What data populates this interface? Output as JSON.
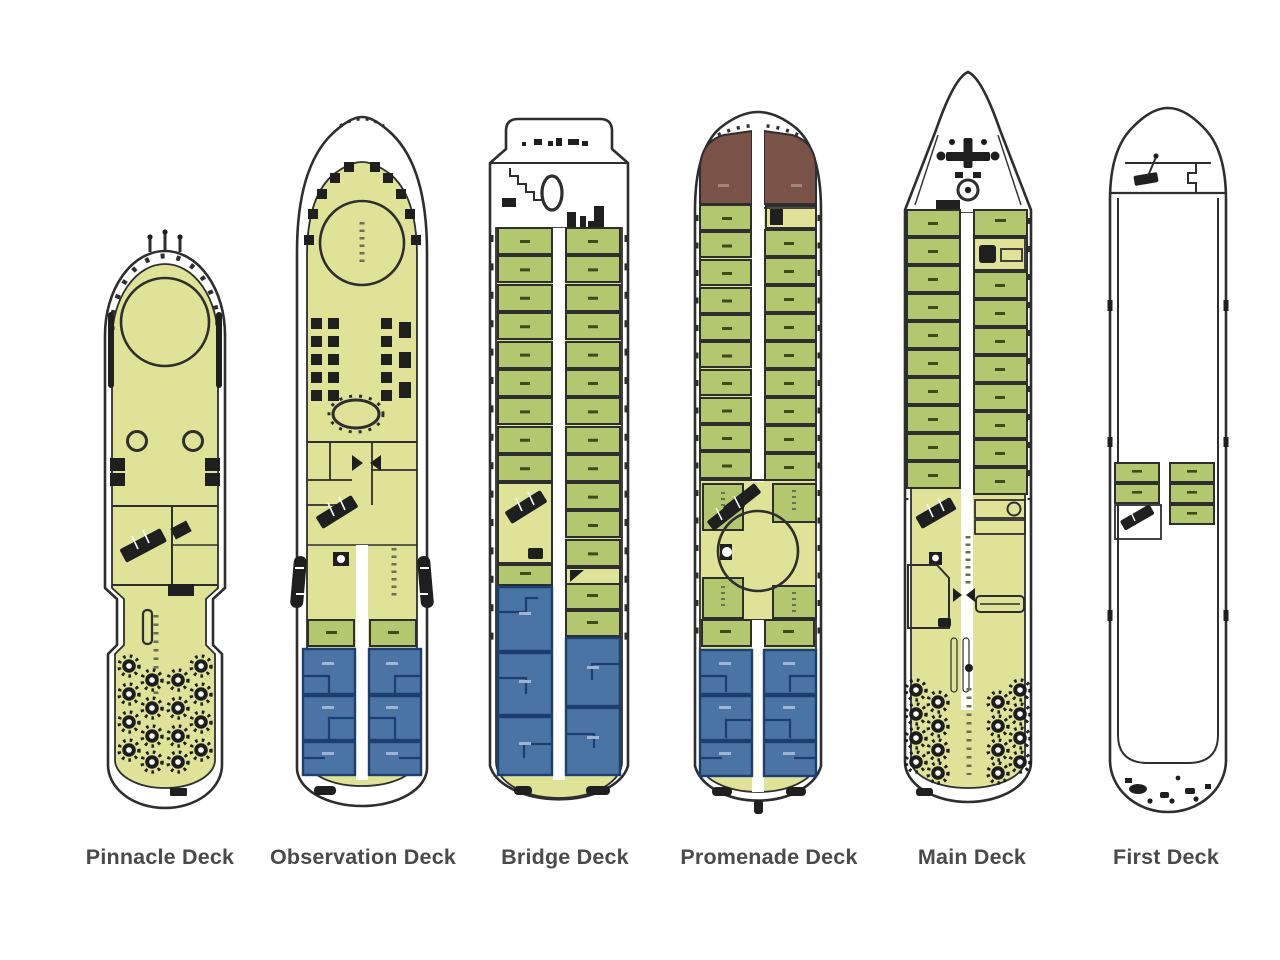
{
  "diagram": {
    "type": "cruise-ship-deck-plan",
    "deck_count": 6
  },
  "decks": [
    {
      "id": "pinnacle",
      "label": "Pinnacle Deck"
    },
    {
      "id": "observation",
      "label": "Observation Deck"
    },
    {
      "id": "bridge",
      "label": "Bridge Deck"
    },
    {
      "id": "promenade",
      "label": "Promenade Deck"
    },
    {
      "id": "main",
      "label": "Main Deck"
    },
    {
      "id": "first",
      "label": "First Deck"
    }
  ],
  "legend_colors": {
    "deck_floor": "#dfe398",
    "cabin_green": "#b3c76f",
    "suite_blue": "#4a74a4",
    "suite_blue_dark": "#1d3f6e",
    "lounge_brown": "#7b5248",
    "outline": "#2e2e2e",
    "label_text": "#4a4a4a"
  },
  "icons": [
    "stairs-icon",
    "lifeboat-icon",
    "anchor-windlass-icon",
    "table-seating-icon",
    "whirlpool-icon",
    "door-icon"
  ]
}
